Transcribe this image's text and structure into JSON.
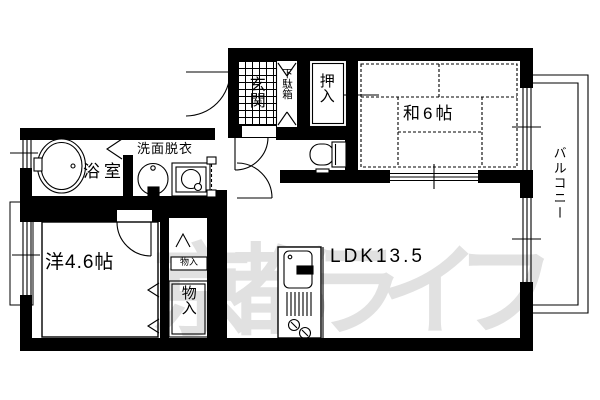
{
  "plan": {
    "rooms": {
      "genkan": "玄関",
      "getabako": "下駄箱",
      "oshiire": "押入",
      "washitsu": "和6帖",
      "balcony": "バルコニー",
      "senmen": "洗面脱衣",
      "bath": "浴室",
      "western": "洋4.6帖",
      "ldk": "LDK13.5",
      "storage_small": "物入",
      "storage_large": "物入"
    },
    "watermark": "京都ライフ",
    "colors": {
      "wall": "#000000",
      "background": "#ffffff",
      "watermark": "#e1e1e1"
    }
  }
}
